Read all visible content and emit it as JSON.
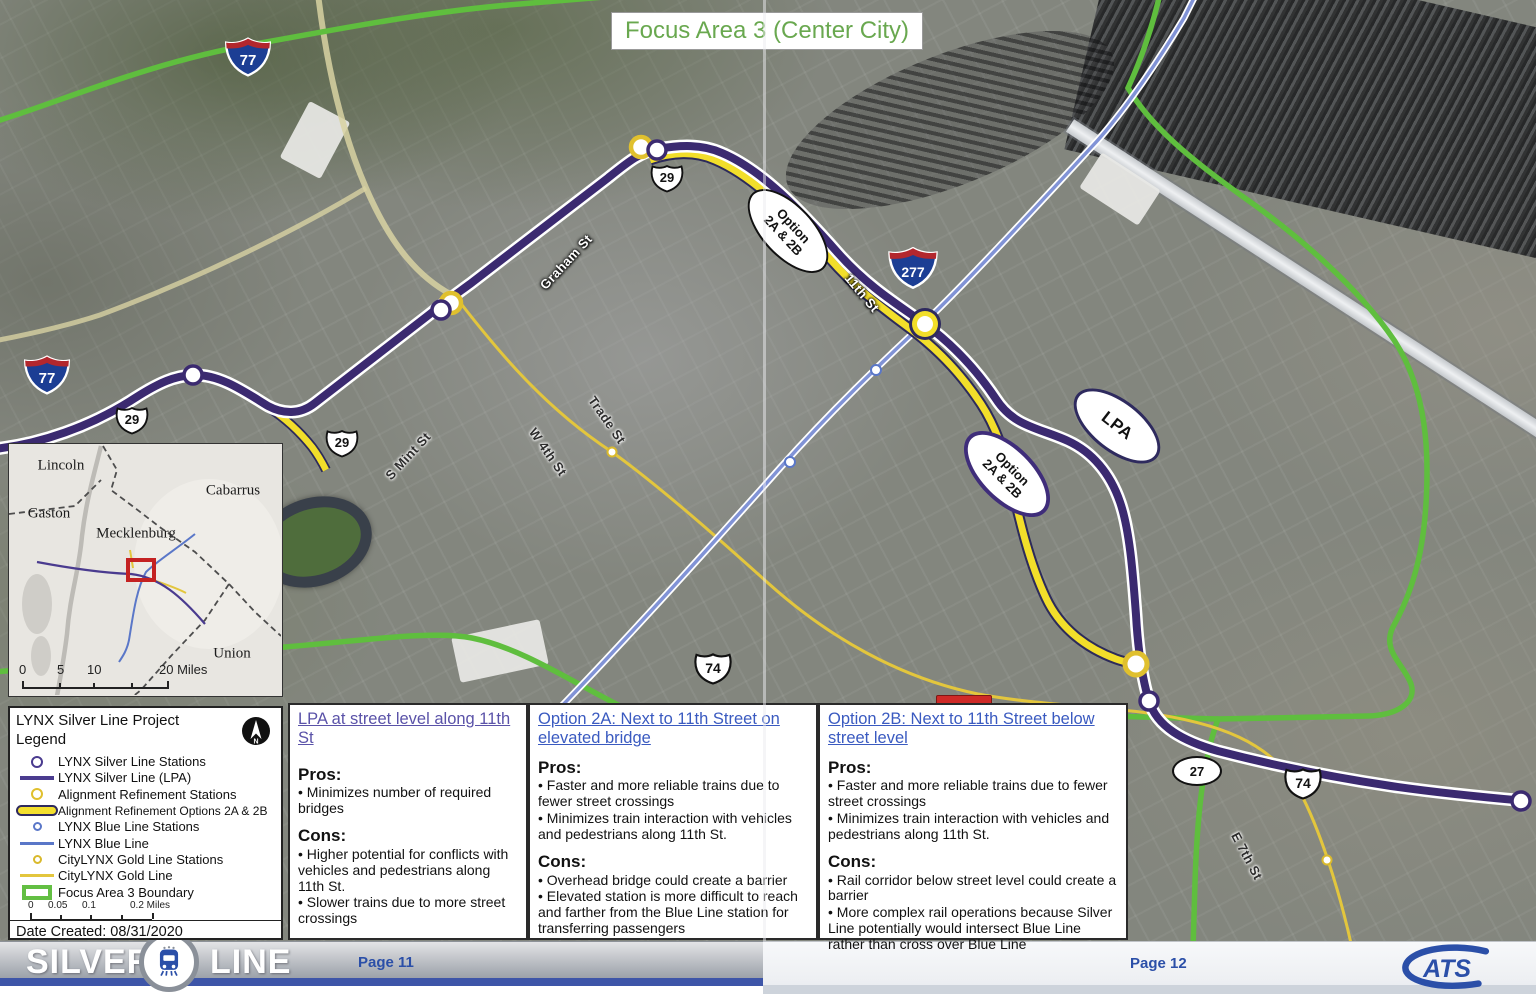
{
  "title_banner": {
    "text": "Focus Area 3 (Center City)"
  },
  "map": {
    "callouts": {
      "option_a": {
        "line1": "Option",
        "line2": "2A & 2B"
      },
      "option_b": {
        "line1": "Option",
        "line2": "2A & 2B"
      },
      "lpa": {
        "label": "LPA"
      }
    },
    "shields": {
      "i77_top": "77",
      "i77_left": "77",
      "i277": "277",
      "us29_top": "29",
      "us29_left": "29",
      "us29_mid": "29",
      "us74_mid": "74",
      "us74_right": "74",
      "nc27": "27"
    },
    "street_labels": {
      "graham": "Graham St",
      "eleventh": "11th St",
      "mint": "S Mint St",
      "fourth": "W 4th St",
      "trade": "Trade St",
      "seventh": "E 7th St"
    }
  },
  "inset": {
    "counties": {
      "lincoln": "Lincoln",
      "gaston": "Gaston",
      "cabarrus": "Cabarrus",
      "mecklenburg": "Mecklenburg",
      "union": "Union"
    },
    "scale": {
      "t0": "0",
      "t1": "5",
      "t2": "10",
      "t3": "20 Miles"
    }
  },
  "legend": {
    "title": "LYNX Silver Line Project Legend",
    "items": [
      "LYNX Silver Line Stations",
      "LYNX Silver Line (LPA)",
      "Alignment Refinement Stations",
      "Alignment Refinement Options 2A & 2B",
      "LYNX Blue Line Stations",
      "LYNX Blue Line",
      "CityLYNX Gold Line Stations",
      "CityLYNX Gold Line",
      "Focus Area 3 Boundary"
    ],
    "scale": {
      "t0": "0",
      "t1": "0.05",
      "t2": "0.1",
      "t3": "0.2 Miles"
    },
    "date": "Date Created: 08/31/2020"
  },
  "boxes": [
    {
      "title": "LPA at street level along 11th St",
      "pros_label": "Pros:",
      "pros": [
        "Minimizes number of required bridges"
      ],
      "cons_label": "Cons:",
      "cons": [
        "Higher potential for conflicts with vehicles and pedestrians along 11th St.",
        "Slower trains due to more street crossings"
      ]
    },
    {
      "title": "Option 2A: Next to 11th Street on elevated bridge",
      "pros_label": "Pros:",
      "pros": [
        "Faster and more reliable trains due to fewer street crossings",
        "Minimizes train interaction with vehicles and pedestrians along 11th St."
      ],
      "cons_label": "Cons:",
      "cons": [
        "Overhead bridge could create a barrier",
        "Elevated station is more difficult to reach and farther from the Blue Line station for transferring passengers"
      ]
    },
    {
      "title": "Option 2B: Next to 11th Street below street level",
      "pros_label": "Pros:",
      "pros": [
        "Faster and more reliable trains due to fewer street crossings",
        "Minimizes train interaction with vehicles and pedestrians along 11th St."
      ],
      "cons_label": "Cons:",
      "cons": [
        "Rail corridor below street level could create a barrier",
        "More complex rail operations because Silver Line potentially would intersect Blue Line rather than cross over Blue Line"
      ]
    }
  ],
  "footer": {
    "brand_silver": "SILVER",
    "brand_line": "LINE",
    "page_left": "Page 11",
    "page_right": "Page 12",
    "cats_logo_text": "ATS"
  },
  "colors": {
    "title_green": "#69a84f",
    "silver_line_purple": "#3b2a70",
    "option_yellow": "#f2de2a",
    "blue_line": "#8193d6",
    "gold_line": "#e3c63d",
    "boundary_green": "#5fbe3e",
    "footer_blue": "#2b4fa8",
    "box_title_blue": "#3a5ac0",
    "box1_title_purple": "#5a52a8"
  }
}
